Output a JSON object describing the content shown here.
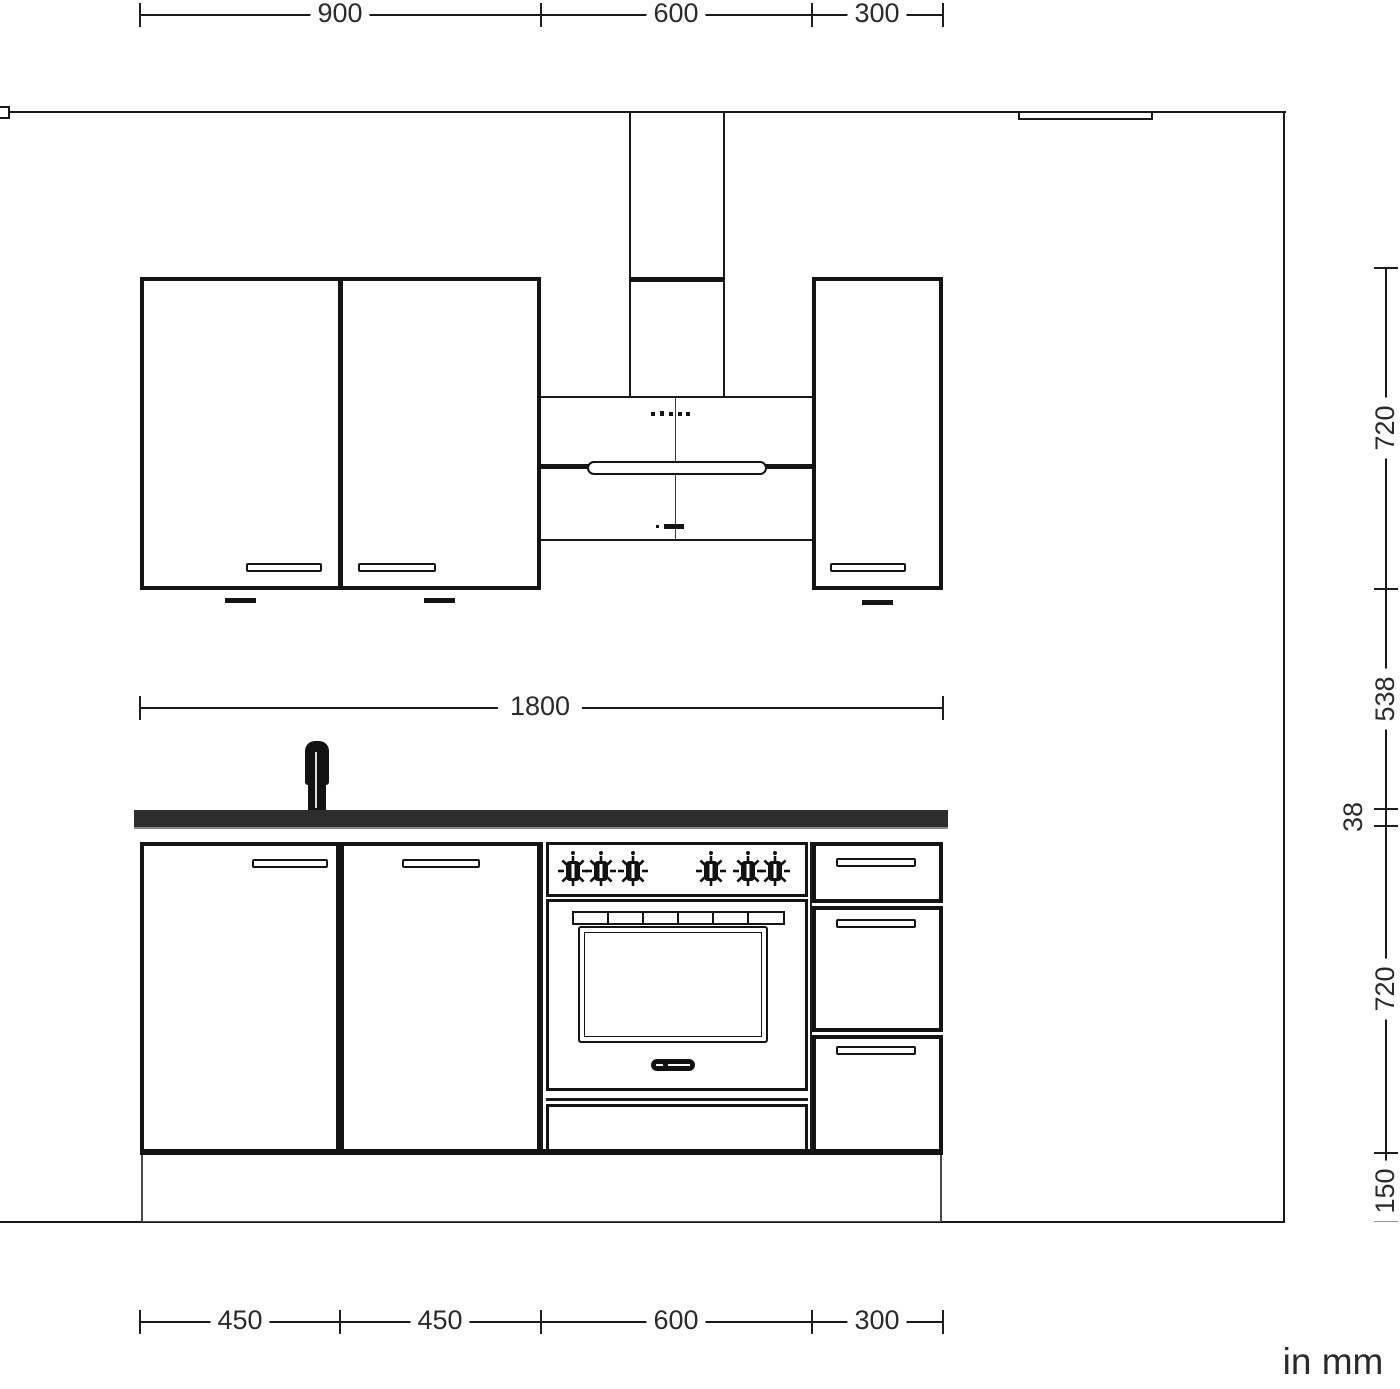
{
  "units_note": "in mm",
  "dimensions": {
    "top": [
      "900",
      "600",
      "300"
    ],
    "total_width": "1800",
    "bottom": [
      "450",
      "450",
      "600",
      "300"
    ],
    "right": [
      "720",
      "538",
      "38",
      "720",
      "150"
    ]
  },
  "colors": {
    "line": "#1a1a1a",
    "worktop": "#2d2d2d",
    "background": "#ffffff",
    "dim_text": "#2b2b2b"
  },
  "icons": {
    "burner_knob": "radial-dial-shape",
    "faucet": "tap-silhouette",
    "hood_handle": "rounded-pill-bar"
  }
}
